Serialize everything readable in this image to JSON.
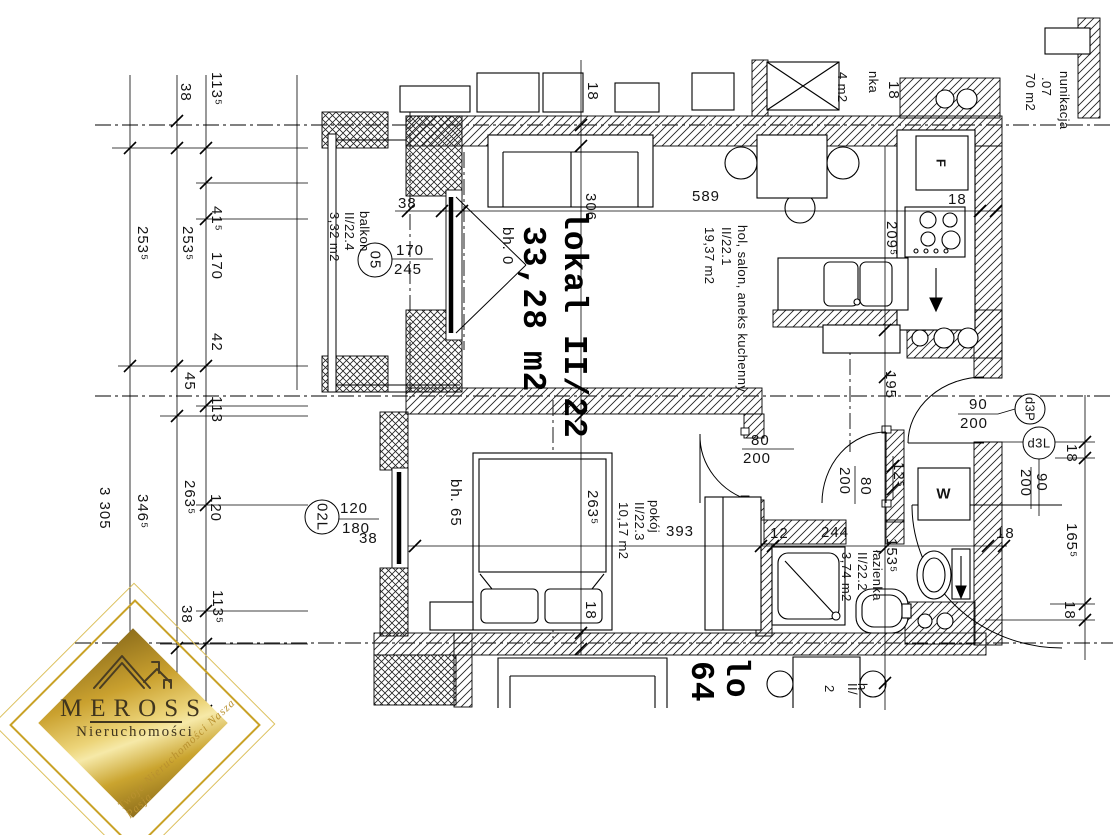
{
  "unit": {
    "name": "lokal II/22",
    "area": "33,28 m2"
  },
  "rooms": {
    "hol": {
      "name": "hol, salon, aneks kuchenny",
      "id": "II/22.1",
      "area": "19,37 m2"
    },
    "lazienka": {
      "name": "łazienka",
      "id": "II/22.2",
      "area": "3,74 m2"
    },
    "pokoj": {
      "name": "pokój",
      "id": "II/22.3",
      "area": "10,17 m2"
    },
    "balkon": {
      "name": "balkon",
      "id": "II/22.4",
      "area": "3,32 m2"
    },
    "komunikacja": {
      "name": "nunikacja",
      "id": ".07",
      "area": "70 m2"
    }
  },
  "neighbors": {
    "upper": {
      "area_fragment": "4 m2",
      "name_fragment": "nka"
    },
    "lower": {
      "unit_fragment_1": "lo",
      "unit_fragment_2": "64",
      "label_fragment_1": "h",
      "label_fragment_2": "II/",
      "label_fragment_3": "2"
    }
  },
  "fixtures": {
    "fridge": "F",
    "washer": "W"
  },
  "markers": {
    "balcony_window": "05",
    "bedroom_window": "02L",
    "door_top": "d3P",
    "door_bottom": "d3L"
  },
  "dims": {
    "left_top_38": "38",
    "left_top_1135": "113⁵",
    "left_2535_a": "253⁵",
    "left_2535_b": "253⁵",
    "left_415": "41⁵",
    "left_170": "170",
    "left_42": "42",
    "left_45": "45",
    "left_113": "113",
    "left_120": "120",
    "left_2635": "263⁵",
    "left_3465": "346⁵",
    "left_partial": "3 305",
    "left_bot_38": "38",
    "left_bot_1135": "113⁵",
    "top_38": "38",
    "top_18_left": "18",
    "top_306": "306",
    "top_589": "589",
    "top_2095": "209⁵",
    "top_18_right": "18",
    "upper_18": "18",
    "balc_win_w": "170",
    "balc_win_h": "245",
    "bed_win_w": "120",
    "bed_win_h": "180",
    "bed_win_38": "38",
    "bh0": "bh. 0",
    "bh65": "bh. 65",
    "mid_195": "195",
    "mid_125": "12⁵",
    "door_pokoj_w": "80",
    "door_pokoj_h": "200",
    "door_hall_w": "80",
    "door_hall_h": "200",
    "door_ent_w": "90",
    "door_ent_h": "200",
    "door_right_w": "90",
    "door_right_h": "200",
    "right_18_a": "18",
    "right_1655": "165⁵",
    "right_18_b": "18",
    "bath_12": "12",
    "bath_244": "244",
    "bath_18": "18",
    "bath_1535": "153⁵",
    "pokoj_393": "393",
    "pokoj_2635": "263⁵",
    "pokoj_18": "18"
  },
  "logo": {
    "brand": "MEROSS",
    "subtitle": "Nieruchomości",
    "tagline": "Twoje Nieruchomości Nasza Pasja"
  }
}
